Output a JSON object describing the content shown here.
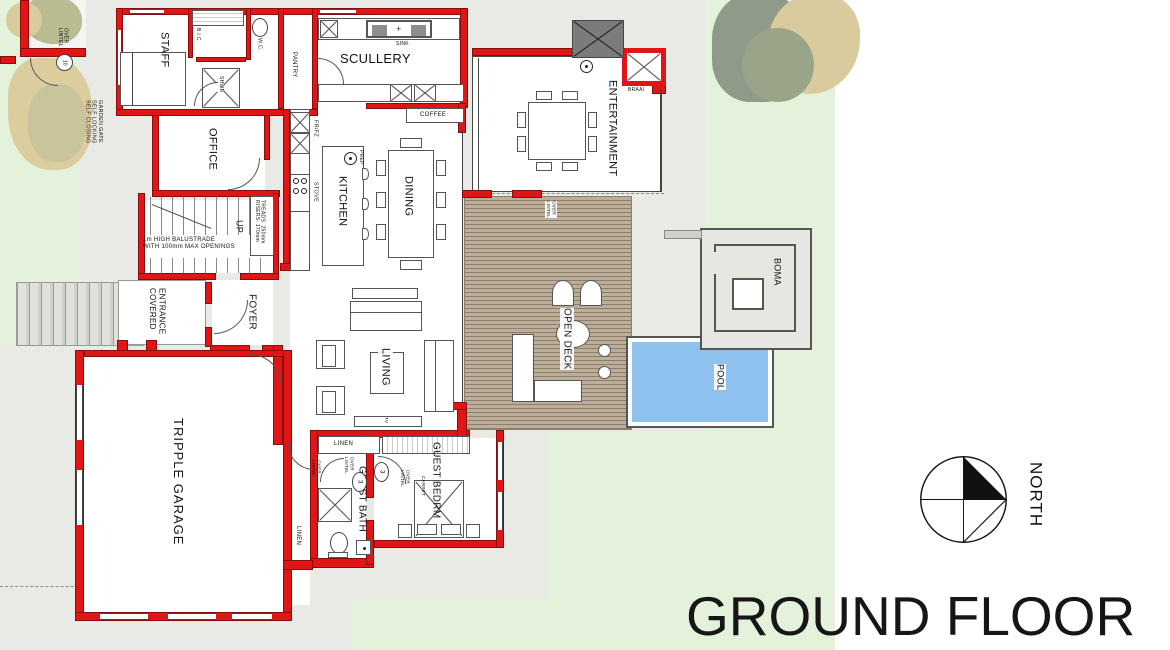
{
  "title": {
    "text": "GROUND FLOOR"
  },
  "compass": {
    "label": "NORTH"
  },
  "rooms": {
    "staff": "STAFF",
    "office": "OFFICE",
    "scullery": "SCULLERY",
    "pantry": "PANTRY",
    "kitchen": "KITCHEN",
    "dining": "DINING",
    "entertainment": "ENTERTAINMENT",
    "covered_entrance": "COVERED\nENTRANCE",
    "foyer": "FOYER",
    "up": "UP",
    "living": "LIVING",
    "open_deck": "OPEN DECK",
    "garage": "TRIPPLE GARAGE",
    "guest_bath": "GUEST BATH",
    "guest_bedroom": "GUEST BEDRM",
    "boma": "BOMA",
    "pool": "POOL"
  },
  "fixtures": {
    "bic": "B.I.C.",
    "wc": "W.C.",
    "shower": "SHWR",
    "sink": "SINK",
    "coffee": "COFFEE",
    "fridge_freezer": "FR/FZ",
    "stove": "STOVE",
    "prep": "PREP",
    "braai": "BRAAI",
    "tv": "TV",
    "carpet": "CARPET",
    "linen_closet": "LINEN",
    "linen_corridor": "LINEN"
  },
  "notes": {
    "balustrade": "1m HIGH BALUSTRADE\nWITH 100mm MAX OPENINGS",
    "stair_spec": "RISERS: 170mm\nTREADS: 250mm",
    "garden_gate": "SELF CLOSING\nSELF LOCKING\nGARDEN GATE",
    "lintel_over": "LINTEL\nOVER",
    "door_no_gate": "10",
    "door_no_3": "3"
  },
  "colors": {
    "wall_red": "#e01515",
    "lawn_green": "#e4f2dc",
    "paving_gray": "#e9e9e6",
    "deck_brown": "#bdae99",
    "pool_blue": "#8fc1ef"
  }
}
